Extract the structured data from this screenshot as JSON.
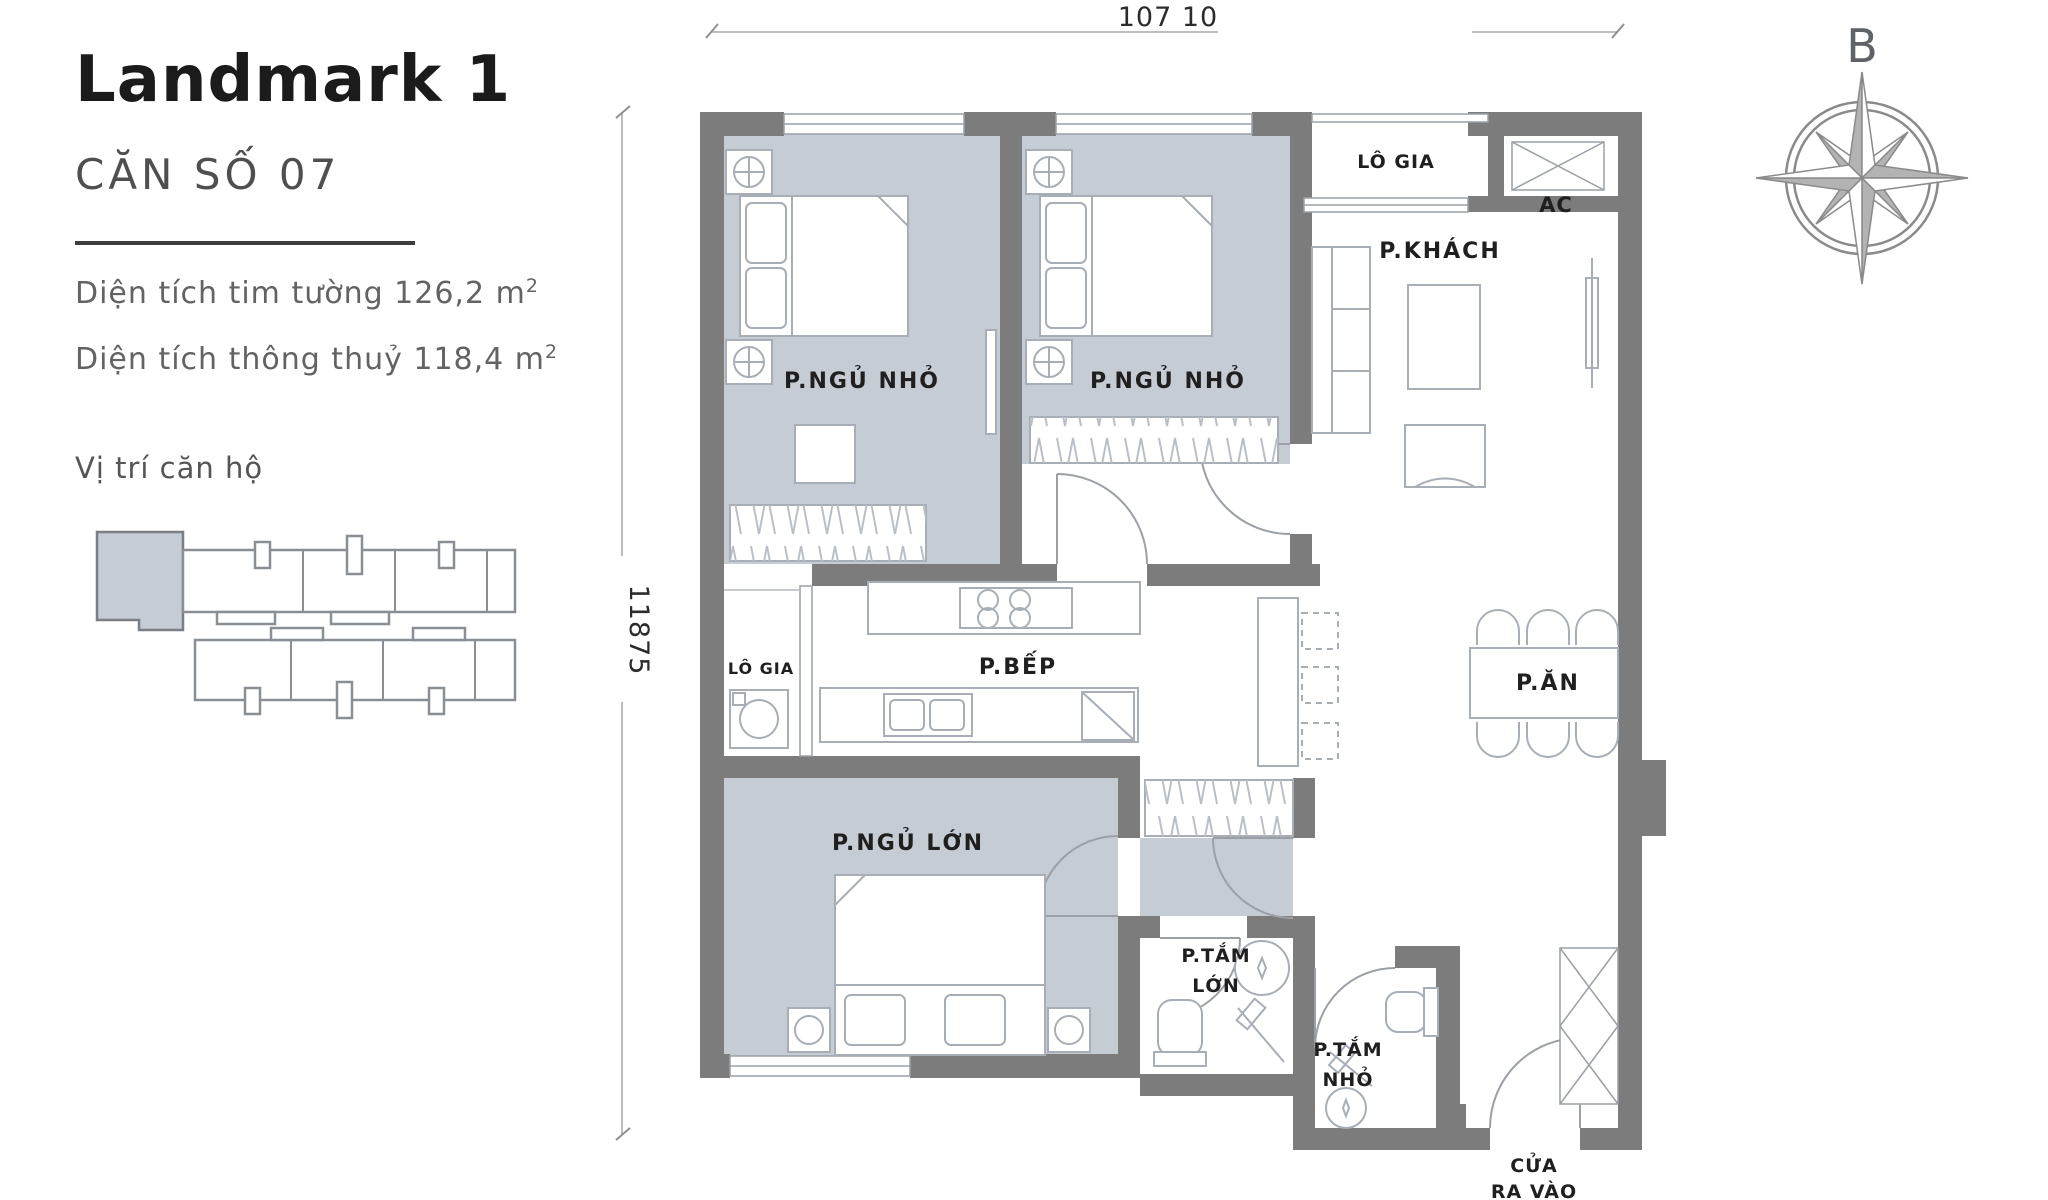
{
  "panel": {
    "title": "Landmark 1",
    "unit": "CĂN SỐ 07",
    "area1": "Diện tích tim tường 126,2 m",
    "area1_sup": "2",
    "area2": "Diện tích thông thuỷ 118,4 m",
    "area2_sup": "2",
    "location_label": "Vị trí căn hộ"
  },
  "dimensions": {
    "top": "107 10",
    "left": "11875"
  },
  "compass": {
    "north_label": "B"
  },
  "rooms": {
    "bedroom_small_1": "P.NGỦ NHỎ",
    "bedroom_small_2": "P.NGỦ NHỎ",
    "logia_top": "LÔ GIA",
    "ac": "AC",
    "living": "P.KHÁCH",
    "logia_side": "LÔ GIA",
    "kitchen": "P.BẾP",
    "dining": "P.ĂN",
    "bedroom_master": "P.NGỦ LỚN",
    "bath_large_1": "P.TẮM",
    "bath_large_2": "LỚN",
    "bath_small_1": "P.TẮM",
    "bath_small_2": "NHỎ",
    "entrance_1": "CỬA",
    "entrance_2": "RA VÀO"
  },
  "colors": {
    "floor": "#c6ccd4",
    "wall": "#7c7c7c",
    "furniture_line": "#a8aeb6",
    "label_text": "#1f1f1f"
  }
}
